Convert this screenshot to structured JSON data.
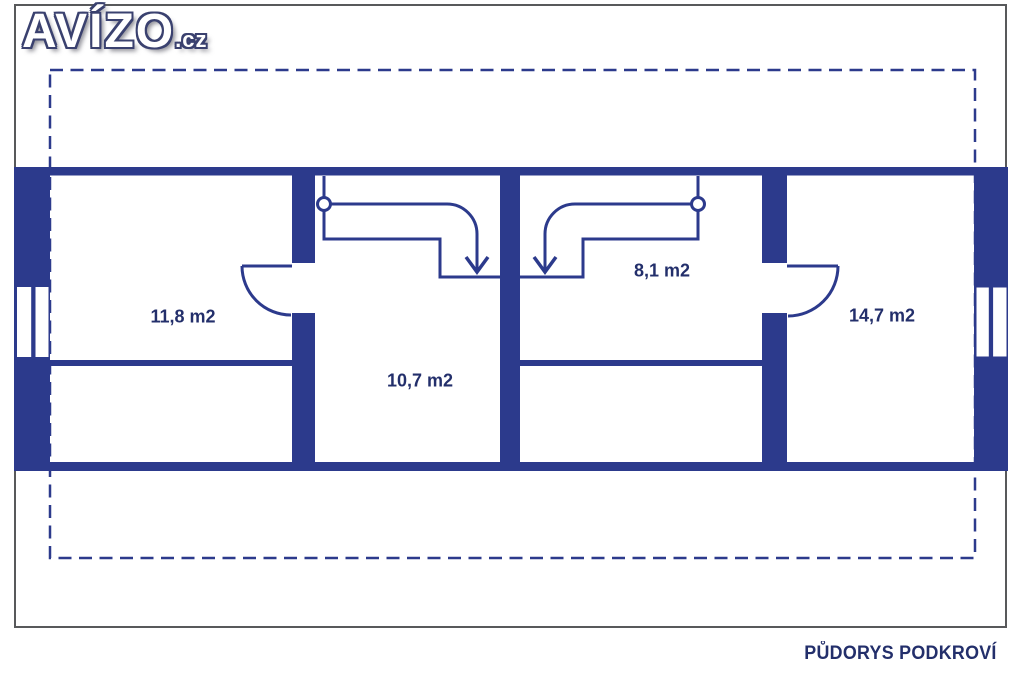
{
  "brand": {
    "logo_text": "AVÍZO",
    "logo_suffix": ".cz"
  },
  "plan": {
    "title": "PŮDORYS PODKROVÍ",
    "rooms": [
      {
        "name": "room-top-left",
        "area_label": "11,8 m2"
      },
      {
        "name": "room-center-left",
        "area_label": "10,7 m2"
      },
      {
        "name": "room-center-right",
        "area_label": "8,1 m2"
      },
      {
        "name": "room-right",
        "area_label": "14,7 m2"
      }
    ]
  },
  "colors": {
    "wall_navy": "#2C3A8C",
    "label_text": "#232F6B",
    "frame_border": "#58595B",
    "background": "#FFFFFF"
  }
}
